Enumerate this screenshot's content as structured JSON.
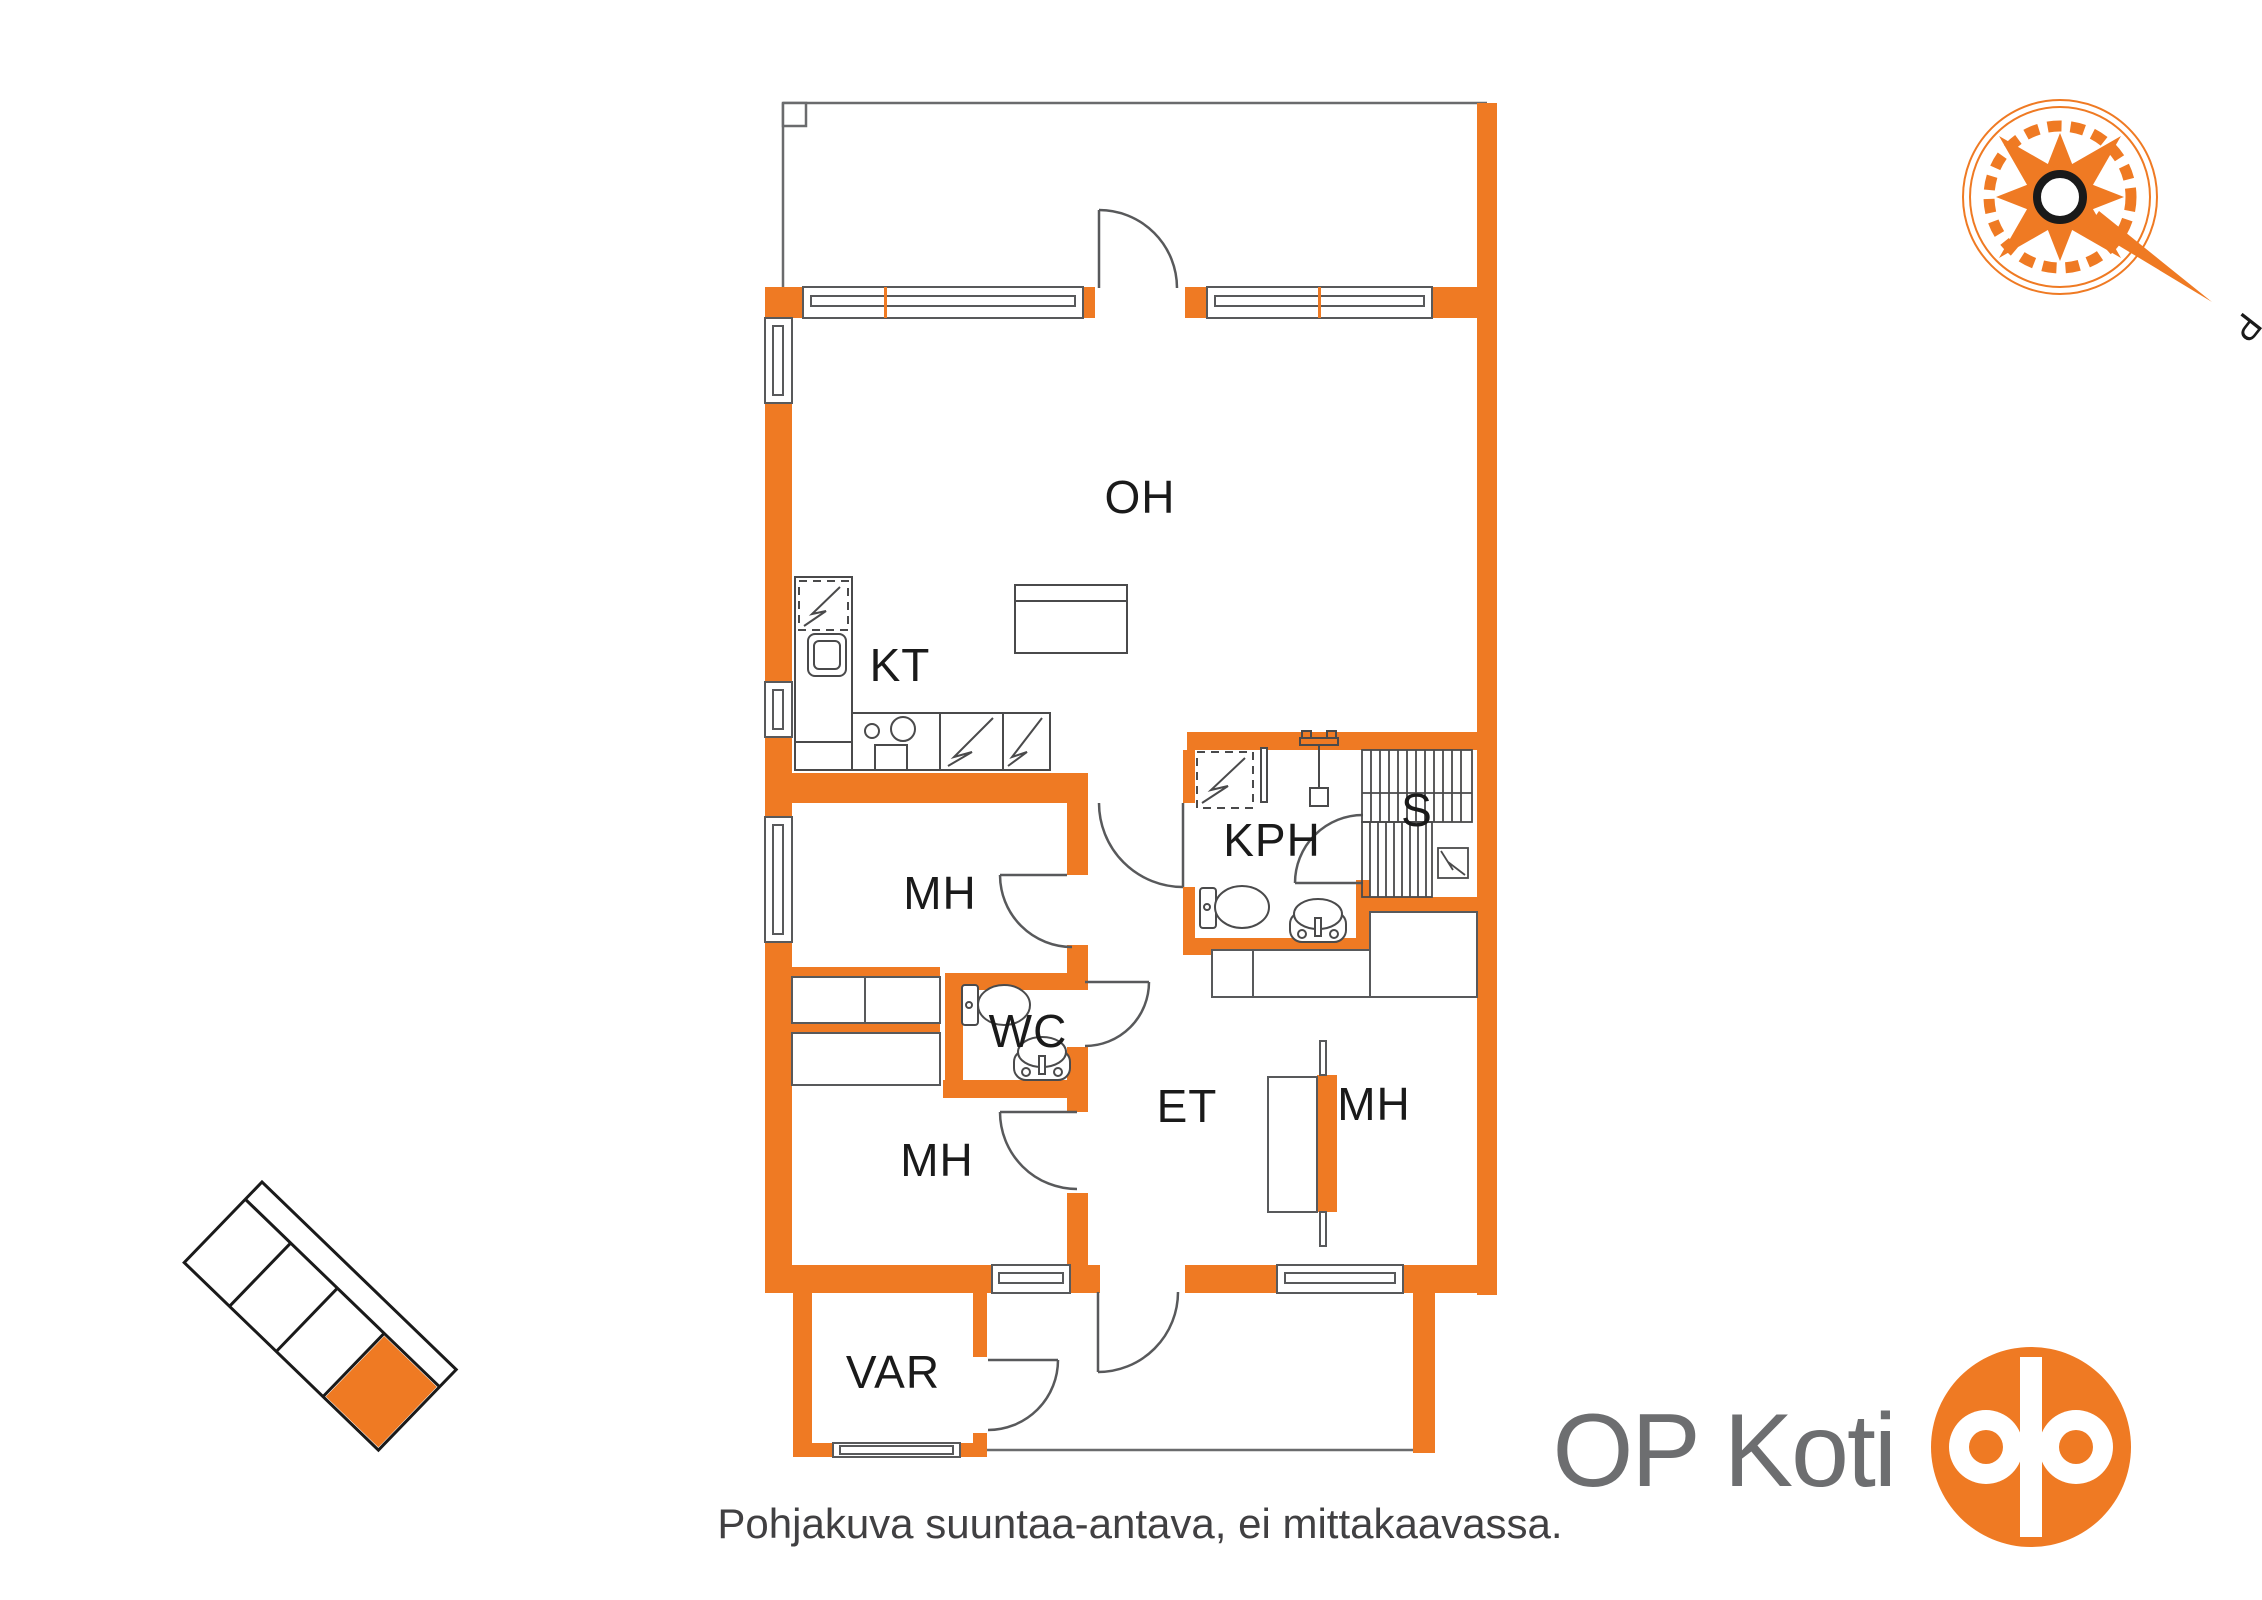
{
  "plan": {
    "rooms": {
      "living": {
        "label": "OH"
      },
      "kitchen": {
        "label": "KT"
      },
      "bedroom1": {
        "label": "MH"
      },
      "wc": {
        "label": "WC"
      },
      "bathroom": {
        "label": "KPH"
      },
      "sauna": {
        "label": "S"
      },
      "entry": {
        "label": "ET"
      },
      "bedroom2": {
        "label": "MH"
      },
      "bedroom3": {
        "label": "MH"
      },
      "storage": {
        "label": "VAR"
      }
    },
    "note": "Pohjakuva suuntaa-antava, ei mittakaavassa."
  },
  "brand": {
    "wordmark": "OP Koti"
  },
  "compass": {
    "north_label": "P"
  },
  "colors": {
    "wall_orange": "#EF7A23",
    "line_gray": "#58595B",
    "fixture_gray": "#4A4A4B",
    "label_black": "#1A1A1A",
    "brand_gray": "#6D6E70",
    "note_gray": "#414042"
  }
}
